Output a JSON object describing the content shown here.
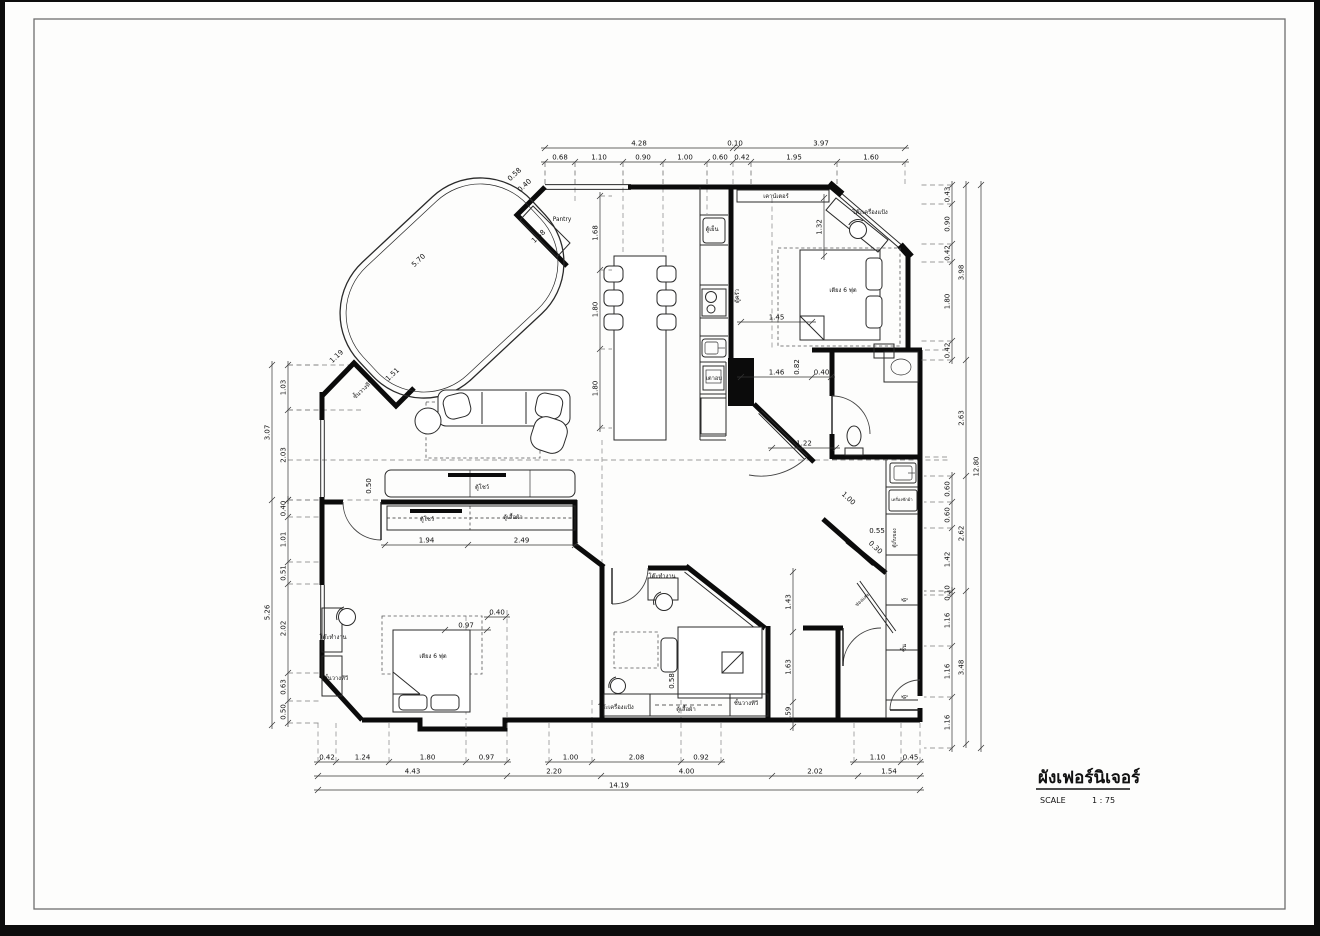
{
  "page": {
    "frame_color": "#0d0d0d",
    "paper_color": "#ffffff",
    "border_color": "#6f6f6f"
  },
  "title_block": {
    "title": "ผังเฟอร์นิเจอร์",
    "scale_label": "SCALE",
    "scale_value": "1 : 75"
  },
  "plan": {
    "chains": [
      {
        "name": "top-overall",
        "o": "h",
        "pos": 148,
        "ticks": [
          545,
          733,
          737,
          905
        ],
        "labels": [
          "4.28",
          "0.10",
          "3.97"
        ],
        "ext": 0
      },
      {
        "name": "top-detail",
        "o": "h",
        "pos": 162,
        "ticks": [
          545,
          575,
          623,
          663,
          707,
          733,
          751,
          837,
          905
        ],
        "labels": [
          "0.68",
          "1.10",
          "0.90",
          "1.00",
          "0.60",
          "0.42",
          "1.95",
          "1.60"
        ],
        "ext": 24
      },
      {
        "name": "left-outer",
        "o": "v",
        "pos": 272,
        "ticks": [
          365,
          500,
          725
        ],
        "labels": [
          "3.07",
          "5.26"
        ],
        "ext": 0
      },
      {
        "name": "left-inner-top",
        "o": "v",
        "pos": 288,
        "ticks": [
          365,
          410,
          500
        ],
        "labels": [
          "1.03",
          "2.03"
        ],
        "ext": 34
      },
      {
        "name": "left-inner-bot",
        "o": "v",
        "pos": 288,
        "ticks": [
          500,
          517,
          562,
          584,
          673,
          701,
          723
        ],
        "labels": [
          "0.40",
          "1.01",
          "0.51",
          "2.02",
          "0.63",
          "0.50"
        ],
        "ext": 34
      },
      {
        "name": "right-outer",
        "o": "v",
        "pos": 981,
        "ticks": [
          185,
          748
        ],
        "labels": [
          "12.80"
        ],
        "ext": 0
      },
      {
        "name": "right-mid",
        "o": "v",
        "pos": 966,
        "ticks": [
          185,
          360,
          476,
          591,
          744
        ],
        "labels": [
          "3.98",
          "2.63",
          "2.62",
          "3.48"
        ],
        "ext": 0
      },
      {
        "name": "right-inner-top",
        "o": "v",
        "pos": 952,
        "ticks": [
          185,
          204,
          244,
          262,
          341,
          360
        ],
        "labels": [
          "0.43",
          "0.90",
          "0.42",
          "1.80",
          "0.42"
        ],
        "ext": -34
      },
      {
        "name": "right-inner-mid",
        "o": "v",
        "pos": 952,
        "ticks": [
          476,
          502,
          528,
          591
        ],
        "labels": [
          "0.60",
          "0.60",
          "1.42"
        ],
        "ext": -28
      },
      {
        "name": "right-inner-bot",
        "o": "v",
        "pos": 952,
        "ticks": [
          591,
          595,
          646,
          697,
          748
        ],
        "labels": [
          "0.10",
          "1.16",
          "1.16",
          "1.16"
        ],
        "ext": -28
      },
      {
        "name": "bottom-inner-a",
        "o": "h",
        "pos": 762,
        "ticks": [
          318,
          336,
          389,
          466,
          507
        ],
        "labels": [
          "0.42",
          "1.24",
          "1.80",
          "0.97"
        ],
        "ext": -40
      },
      {
        "name": "bottom-inner-b",
        "o": "h",
        "pos": 762,
        "ticks": [
          549,
          592,
          681,
          721
        ],
        "labels": [
          "1.00",
          "2.08",
          "0.92"
        ],
        "ext": -40
      },
      {
        "name": "bottom-inner-c",
        "o": "h",
        "pos": 762,
        "ticks": [
          854,
          901,
          920
        ],
        "labels": [
          "1.10",
          "0.45"
        ],
        "ext": -40
      },
      {
        "name": "bottom-mid",
        "o": "h",
        "pos": 776,
        "ticks": [
          318,
          507,
          601,
          772,
          858,
          920
        ],
        "labels": [
          "4.43",
          "2.20",
          "4.00",
          "2.02",
          "1.54"
        ],
        "ext": 0
      },
      {
        "name": "bottom-overall",
        "o": "h",
        "pos": 790,
        "ticks": [
          318,
          920
        ],
        "labels": [
          "14.19"
        ],
        "ext": 0
      },
      {
        "name": "dining-column",
        "o": "v",
        "pos": 600,
        "ticks": [
          196,
          270,
          349,
          428
        ],
        "labels": [
          "1.68",
          "1.80",
          "1.80"
        ],
        "ext": 12
      },
      {
        "name": "bed1-width",
        "o": "h",
        "pos": 322,
        "ticks": [
          741,
          812
        ],
        "labels": [
          "1.45"
        ],
        "ext": 0
      },
      {
        "name": "bed1-width-2",
        "o": "h",
        "pos": 377,
        "ticks": [
          741,
          812,
          831
        ],
        "labels": [
          "1.46",
          "0.40"
        ],
        "ext": 0
      },
      {
        "name": "bed1-height",
        "o": "v",
        "pos": 824,
        "ticks": [
          198,
          256
        ],
        "labels": [
          "1.32"
        ],
        "ext": 0
      },
      {
        "name": "bath-width",
        "o": "h",
        "pos": 448,
        "ticks": [
          772,
          836
        ],
        "labels": [
          "1.22"
        ],
        "ext": 0
      },
      {
        "name": "bed2-heights",
        "o": "v",
        "pos": 793,
        "ticks": [
          572,
          632,
          702,
          727
        ],
        "labels": [
          "1.43",
          "1.63",
          "0.59"
        ],
        "ext": 0
      },
      {
        "name": "bed3-widths",
        "o": "h",
        "pos": 545,
        "ticks": [
          385,
          468,
          575
        ],
        "labels": [
          "1.94",
          "2.49"
        ],
        "ext": 0
      },
      {
        "name": "bed3-small-a",
        "o": "h",
        "pos": 630,
        "ticks": [
          445,
          487
        ],
        "labels": [
          "0.97"
        ],
        "ext": 0
      },
      {
        "name": "bed3-small-b",
        "o": "h",
        "pos": 617,
        "ticks": [
          488,
          506
        ],
        "labels": [
          "0.40"
        ],
        "ext": 0
      }
    ],
    "free_dim_labels": [
      {
        "x": 516,
        "y": 176,
        "t": "0.58",
        "r": -43
      },
      {
        "x": 526,
        "y": 187,
        "t": "0.40",
        "r": -43
      },
      {
        "x": 540,
        "y": 238,
        "t": "1.58",
        "r": -43
      },
      {
        "x": 420,
        "y": 262,
        "t": "5.70",
        "r": -43
      },
      {
        "x": 338,
        "y": 358,
        "t": "1.19",
        "r": -43
      },
      {
        "x": 394,
        "y": 376,
        "t": "1.51",
        "r": -43
      },
      {
        "x": 799,
        "y": 367,
        "t": "0.82",
        "r": -90
      },
      {
        "x": 847,
        "y": 500,
        "t": "1.00",
        "r": 43
      },
      {
        "x": 877,
        "y": 533,
        "t": "0.55",
        "r": 0
      },
      {
        "x": 874,
        "y": 549,
        "t": "0.30",
        "r": 43
      },
      {
        "x": 674,
        "y": 681,
        "t": "0.58",
        "r": -90
      },
      {
        "x": 371,
        "y": 486,
        "t": "0.50",
        "r": -90
      }
    ],
    "room_labels": [
      {
        "x": 562,
        "y": 221,
        "t": "Pantry"
      },
      {
        "x": 776,
        "y": 198,
        "t": "เคาน์เตอร์"
      },
      {
        "x": 870,
        "y": 214,
        "t": "โต๊ะเครื่องแป้ง"
      },
      {
        "x": 843,
        "y": 292,
        "t": "เตียง 6 ฟุต"
      },
      {
        "x": 712,
        "y": 231,
        "t": "ตู้เย็น"
      },
      {
        "x": 739,
        "y": 296,
        "t": "ตู้ครัว",
        "r": -90
      },
      {
        "x": 714,
        "y": 380,
        "t": "เตาอบ"
      },
      {
        "x": 364,
        "y": 391,
        "t": "ชั้นวางทีวี",
        "r": -43
      },
      {
        "x": 482,
        "y": 489,
        "t": "ตู้โชว์"
      },
      {
        "x": 427,
        "y": 521,
        "t": "ตู้โชว์"
      },
      {
        "x": 513,
        "y": 519,
        "t": "ตู้เสื้อผ้า"
      },
      {
        "x": 333,
        "y": 639,
        "t": "โต๊ะทำงาน"
      },
      {
        "x": 336,
        "y": 680,
        "t": "ชั้นวางทีวี"
      },
      {
        "x": 433,
        "y": 658,
        "t": "เตียง 6 ฟุต"
      },
      {
        "x": 662,
        "y": 578,
        "t": "โต๊ะทำงาน"
      },
      {
        "x": 616,
        "y": 709,
        "t": "โต๊ะเครื่องแป้ง"
      },
      {
        "x": 686,
        "y": 711,
        "t": "ตู้เสื้อผ้า"
      },
      {
        "x": 746,
        "y": 705,
        "t": "ชั้นวางทีวี"
      },
      {
        "x": 902,
        "y": 501,
        "t": "เครื่องซักผ้า",
        "fs": 4.2
      },
      {
        "x": 896,
        "y": 538,
        "t": "ตู้เก็บของ",
        "r": -90,
        "fs": 4.8
      },
      {
        "x": 906,
        "y": 600,
        "t": "ตู้",
        "r": -90
      },
      {
        "x": 906,
        "y": 648,
        "t": "ชั้น",
        "r": -90
      },
      {
        "x": 906,
        "y": 697,
        "t": "ตู้",
        "r": -90
      },
      {
        "x": 863,
        "y": 601,
        "t": "ช่องแสง",
        "r": -43,
        "fs": 4.8
      }
    ]
  }
}
